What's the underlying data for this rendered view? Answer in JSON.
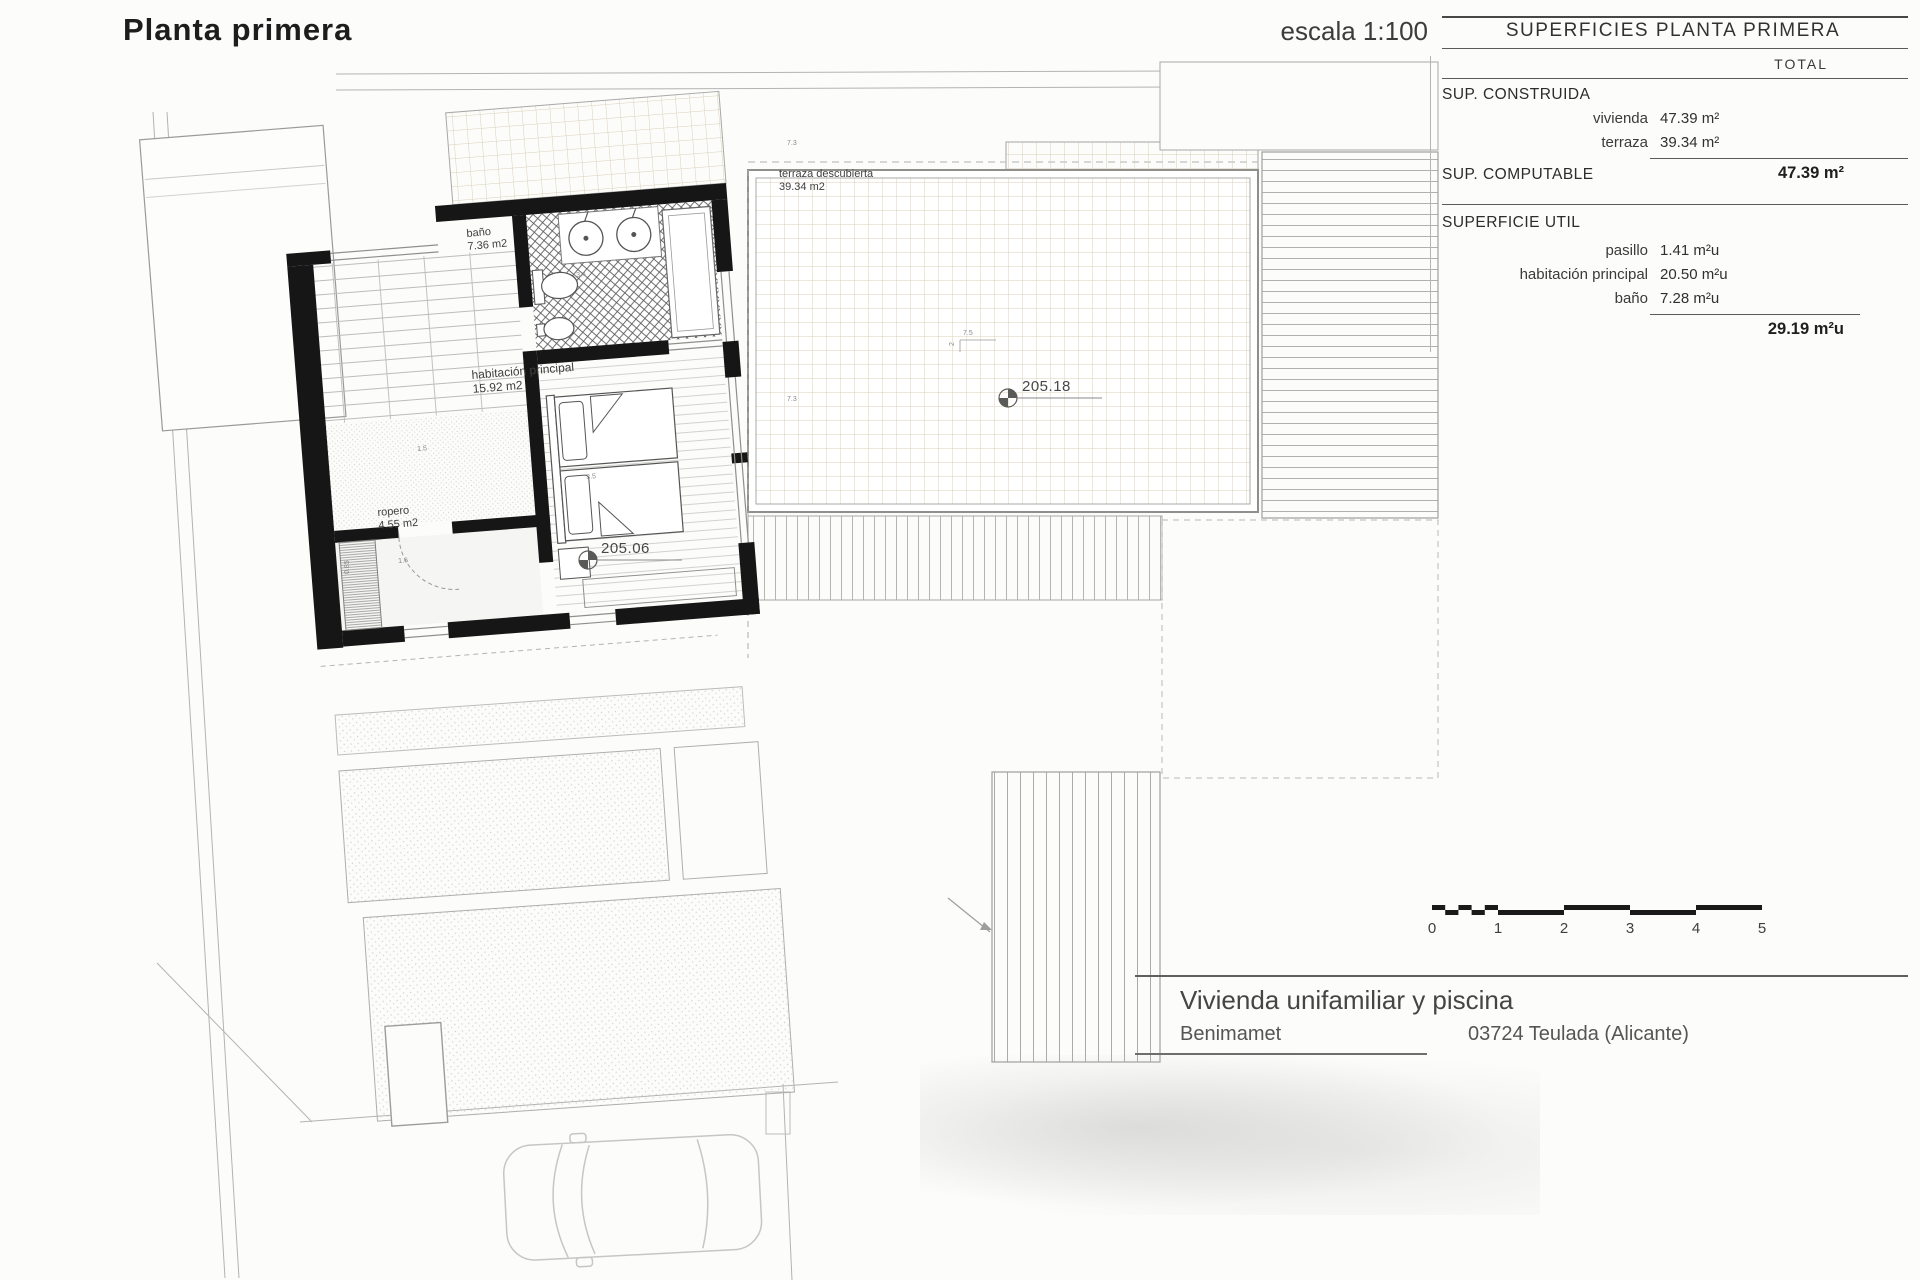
{
  "page": {
    "title": "Planta primera",
    "scale_label": "escala 1:100"
  },
  "surfaces_table": {
    "title": "SUPERFICIES PLANTA PRIMERA",
    "total_header": "TOTAL",
    "constructed": {
      "heading": "SUP. CONSTRUIDA",
      "rows": [
        {
          "label": "vivienda",
          "value": "47.39 m²"
        },
        {
          "label": "terraza",
          "value": "39.34 m²"
        }
      ]
    },
    "computable": {
      "heading": "SUP. COMPUTABLE",
      "total": "47.39 m²"
    },
    "useful": {
      "heading": "SUPERFICIE UTIL",
      "rows": [
        {
          "label": "pasillo",
          "value": "1.41 m²u"
        },
        {
          "label": "habitación principal",
          "value": "20.50 m²u"
        },
        {
          "label": "baño",
          "value": "7.28 m²u"
        }
      ],
      "total": "29.19 m²u"
    }
  },
  "plan": {
    "rooms": [
      {
        "name": "terraza descubierta",
        "area": "39.34 m2"
      },
      {
        "name": "baño",
        "area": "7.36 m2"
      },
      {
        "name": "habitación principal",
        "area": "15.92 m2"
      },
      {
        "name": "ropero",
        "area": "4.55 m2"
      }
    ],
    "levels": [
      {
        "value": "205.18"
      },
      {
        "value": "205.06"
      }
    ],
    "dims": [
      "7.3",
      "7.5",
      "2",
      "7.3",
      "3.4",
      "3.5",
      "1.6",
      "1.5",
      "0.85"
    ]
  },
  "scale_bar": {
    "ticks": [
      "0",
      "1",
      "2",
      "3",
      "4",
      "5"
    ]
  },
  "title_block": {
    "project": "Vivienda unifamiliar y piscina",
    "location": "Benimamet",
    "address": "03724 Teulada (Alicante)"
  },
  "colors": {
    "paper": "#fcfcfa",
    "wall": "#161616",
    "line_gray": "#8f8f8f",
    "terrace_grid": "#d9d2ba",
    "text_dark": "#1d1d1d"
  }
}
